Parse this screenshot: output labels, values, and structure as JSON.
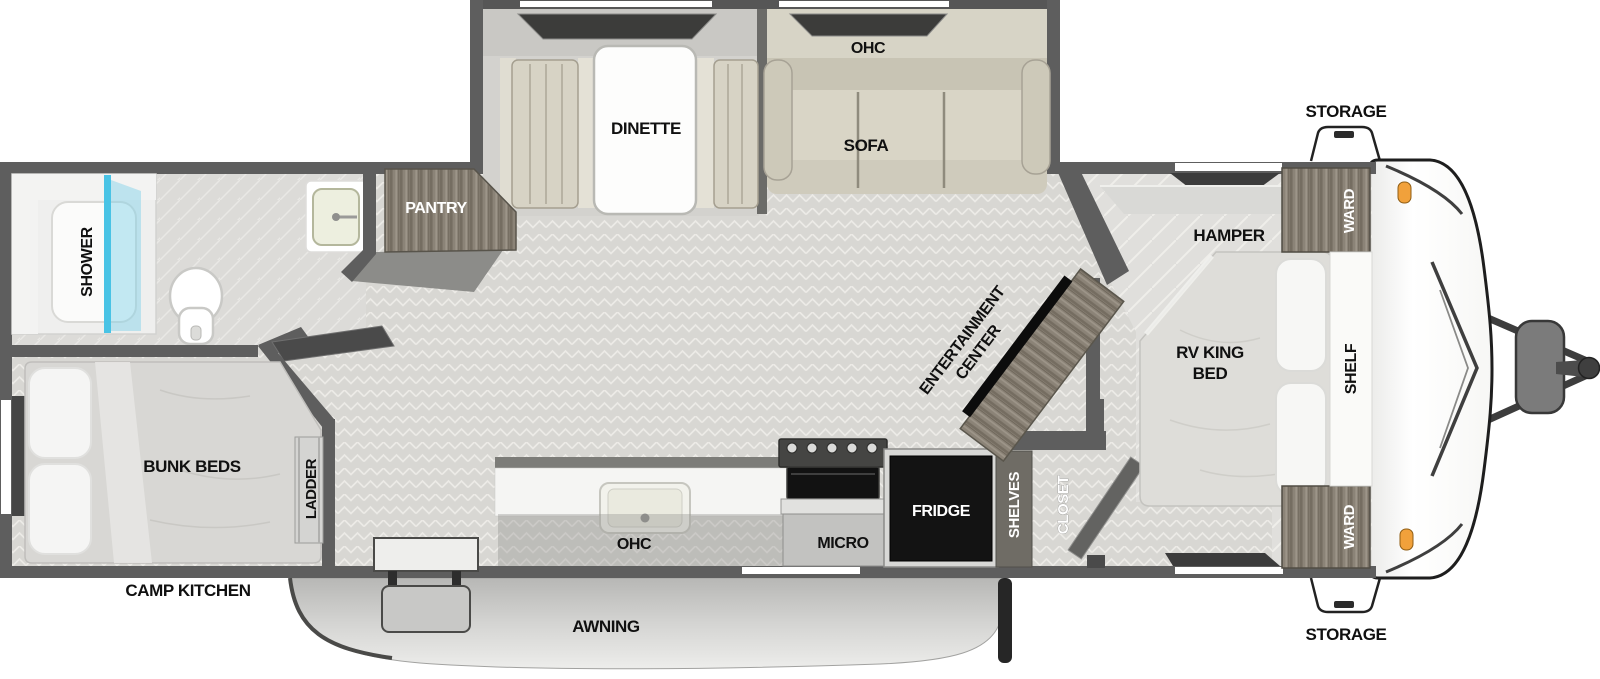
{
  "colors": {
    "wall": "#5e5e5e",
    "floor_tile": "#d8d7d3",
    "cabinet_wood": "#8b8377",
    "shower_glass": "#49c3e5",
    "marker_light": "#f1a13b",
    "fridge": "#131313",
    "awning": "#cfcfcd"
  },
  "exterior": {
    "storage_front_top": "STORAGE",
    "storage_front_bottom": "STORAGE",
    "awning": "AWNING",
    "camp_kitchen": "CAMP KITCHEN"
  },
  "slideout": {
    "dinette": "DINETTE",
    "sofa": "SOFA",
    "ohc": "OHC"
  },
  "kitchen": {
    "ohc": "OHC",
    "micro": "MICRO",
    "fridge": "FRIDGE"
  },
  "bath": {
    "shower": "SHOWER",
    "pantry": "PANTRY"
  },
  "bunk_room": {
    "bunk_beds": "BUNK BEDS",
    "ladder": "LADDER"
  },
  "hall": {
    "entertainment_line1": "ENTERTAINMENT",
    "entertainment_line2": "CENTER",
    "shelves": "SHELVES",
    "closet": "CLOSET"
  },
  "bedroom": {
    "hamper": "HAMPER",
    "ward_top": "WARD",
    "ward_bottom": "WARD",
    "bed_line1": "RV KING",
    "bed_line2": "BED",
    "shelf": "SHELF"
  }
}
